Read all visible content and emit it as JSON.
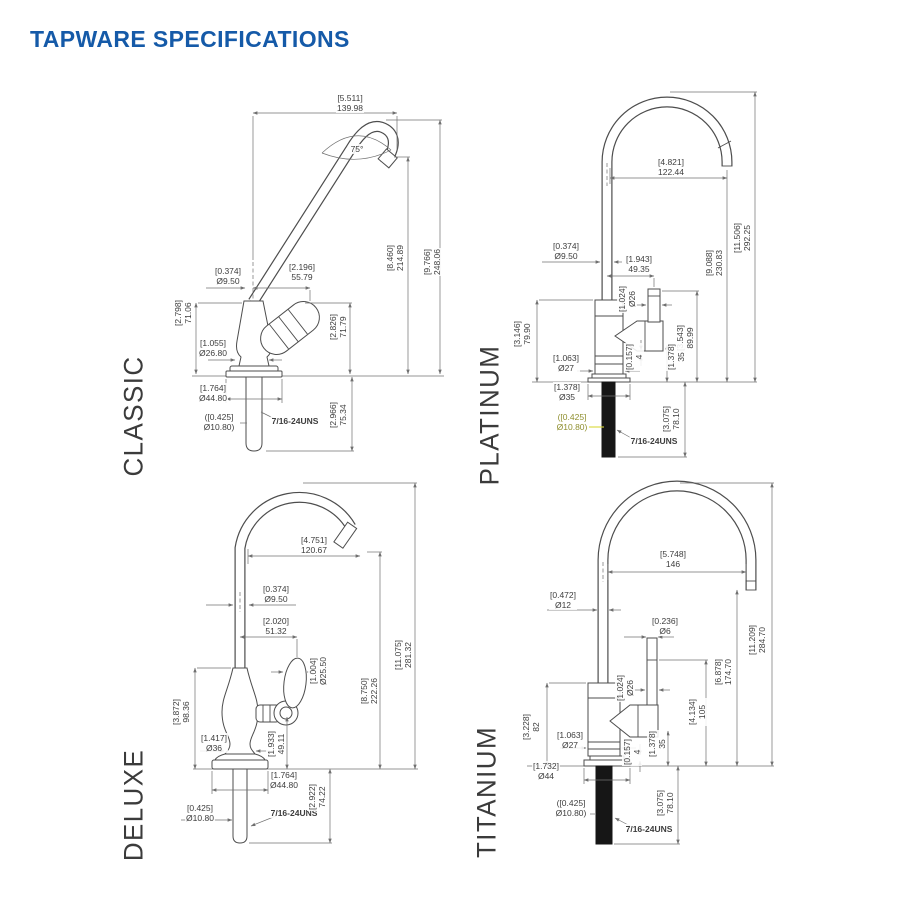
{
  "title": "TAPWARE SPECIFICATIONS",
  "accent_color": "#155AA8",
  "thread_spec": "7/16-24UNS",
  "variants": {
    "classic": {
      "name": "CLASSIC",
      "dims": {
        "spout_span": {
          "in": "[5.511]",
          "mm": "139.98"
        },
        "spout_angle": {
          "deg": "75°"
        },
        "outlet_height": {
          "in": "[8.460]",
          "mm": "214.89"
        },
        "overall_height": {
          "in": "[9.766]",
          "mm": "248.06"
        },
        "spout_od": {
          "in": "[0.374]",
          "mm": "Ø9.50"
        },
        "handle_reach": {
          "in": "[2.196]",
          "mm": "55.79"
        },
        "body_height": {
          "in": "[2.798]",
          "mm": "71.06"
        },
        "body_od": {
          "in": "[1.055]",
          "mm": "Ø26.80"
        },
        "handle_height": {
          "in": "[2.826]",
          "mm": "71.79"
        },
        "flange_od": {
          "in": "[1.764]",
          "mm": "Ø44.80"
        },
        "supply_od": {
          "in": "([0.425]",
          "mm": "Ø10.80)"
        },
        "shank_length": {
          "in": "[2.966]",
          "mm": "75.34"
        }
      }
    },
    "platinum": {
      "name": "PLATINUM",
      "dims": {
        "spout_span": {
          "in": "[4.821]",
          "mm": "122.44"
        },
        "overall_height": {
          "in": "[11.506]",
          "mm": "292.25"
        },
        "outlet_height": {
          "in": "[9.088]",
          "mm": "230.83"
        },
        "spout_od": {
          "in": "[0.374]",
          "mm": "Ø9.50"
        },
        "handle_reach": {
          "in": "[1.943]",
          "mm": "49.35"
        },
        "body_height": {
          "in": "[3.146]",
          "mm": "79.90"
        },
        "lever_od": {
          "in": "[1.024]",
          "mm": "Ø26"
        },
        "handle_height": {
          "in": "[3.543]",
          "mm": "89.99"
        },
        "body_od": {
          "in": "[1.063]",
          "mm": "Ø27"
        },
        "gap": {
          "in": "[0.157]",
          "mm": "4"
        },
        "base_height": {
          "in": "[1.378]",
          "mm": "35"
        },
        "flange_od": {
          "in": "[1.378]",
          "mm": "Ø35"
        },
        "supply_od": {
          "in": "([0.425]",
          "mm": "Ø10.80)"
        },
        "shank_length": {
          "in": "[3.075]",
          "mm": "78.10"
        }
      }
    },
    "deluxe": {
      "name": "DELUXE",
      "dims": {
        "spout_span": {
          "in": "[4.751]",
          "mm": "120.67"
        },
        "spout_od": {
          "in": "[0.374]",
          "mm": "Ø9.50"
        },
        "handle_reach": {
          "in": "[2.020]",
          "mm": "51.32"
        },
        "overall_height": {
          "in": "[11.075]",
          "mm": "281.32"
        },
        "knob_od": {
          "in": "[1.004]",
          "mm": "Ø25.50"
        },
        "outlet_height": {
          "in": "[8.750]",
          "mm": "222.26"
        },
        "body_height": {
          "in": "[3.872]",
          "mm": "98.36"
        },
        "body_od": {
          "in": "[1.417]",
          "mm": "Ø36"
        },
        "handle_height": {
          "in": "[1.933]",
          "mm": "49.11"
        },
        "flange_od": {
          "in": "[1.764]",
          "mm": "Ø44.80"
        },
        "supply_od": {
          "in": "[0.425]",
          "mm": "Ø10.80"
        },
        "shank_length": {
          "in": "[2.922]",
          "mm": "74.22"
        }
      }
    },
    "titanium": {
      "name": "TITANIUM",
      "dims": {
        "spout_span": {
          "in": "[5.748]",
          "mm": "146"
        },
        "spout_od": {
          "in": "[0.472]",
          "mm": "Ø12"
        },
        "lever_rod_od": {
          "in": "[0.236]",
          "mm": "Ø6"
        },
        "overall_height": {
          "in": "[11.209]",
          "mm": "284.70"
        },
        "outlet_height": {
          "in": "[6.878]",
          "mm": "174.70"
        },
        "handle_height": {
          "in": "[4.134]",
          "mm": "105"
        },
        "lever_od": {
          "in": "[1.024]",
          "mm": "Ø26"
        },
        "body_height": {
          "in": "[3.228]",
          "mm": "82"
        },
        "body_od": {
          "in": "[1.063]",
          "mm": "Ø27"
        },
        "gap": {
          "in": "[0.157]",
          "mm": "4"
        },
        "base_height": {
          "in": "[1.378]",
          "mm": "35"
        },
        "flange_od": {
          "in": "[1.732]",
          "mm": "Ø44"
        },
        "supply_od": {
          "in": "([0.425]",
          "mm": "Ø10.80)"
        },
        "shank_length": {
          "in": "[3.075]",
          "mm": "78.10"
        }
      }
    }
  }
}
